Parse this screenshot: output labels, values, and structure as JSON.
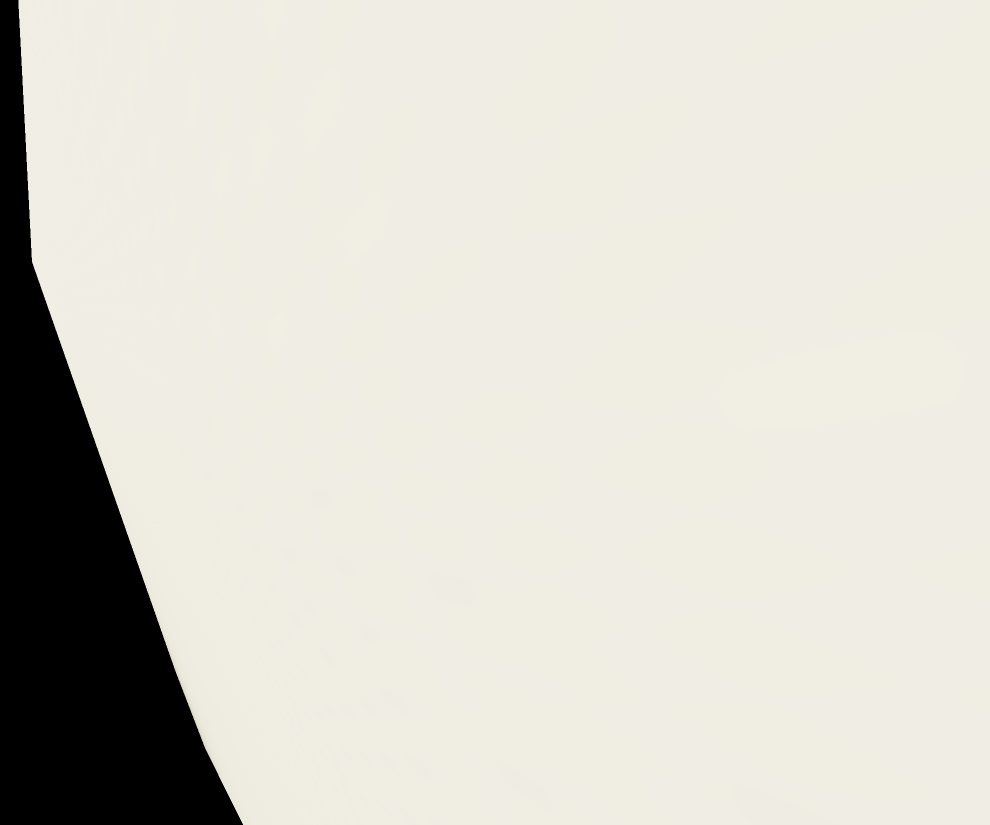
{
  "background_color": "#000000",
  "box": {
    "label": {
      "series_line1": "House of",
      "series_line2": "miniature",
      "product_line1": "Bath",
      "product_line2": "room",
      "brand": "maileg"
    },
    "warning": {
      "icon": "⚠",
      "title": "WARNING:",
      "line1": "CHOKING HAZARD - Small parts",
      "line2": "Not for children under 3 years",
      "line3": "The toy must be assembled by an adult"
    },
    "colors": {
      "label_background": "#c7a069",
      "label_text": "#f2ebd8",
      "front_face": "#d5d9cb",
      "side_face": "#e9e7db",
      "warning_text": "#4a5763",
      "photo_wall_blue": "#a7b8c2",
      "photo_floor_wood": "#8e877c",
      "rack_teal": "#74a898",
      "lamp_mint": "#8fc5bb"
    }
  }
}
